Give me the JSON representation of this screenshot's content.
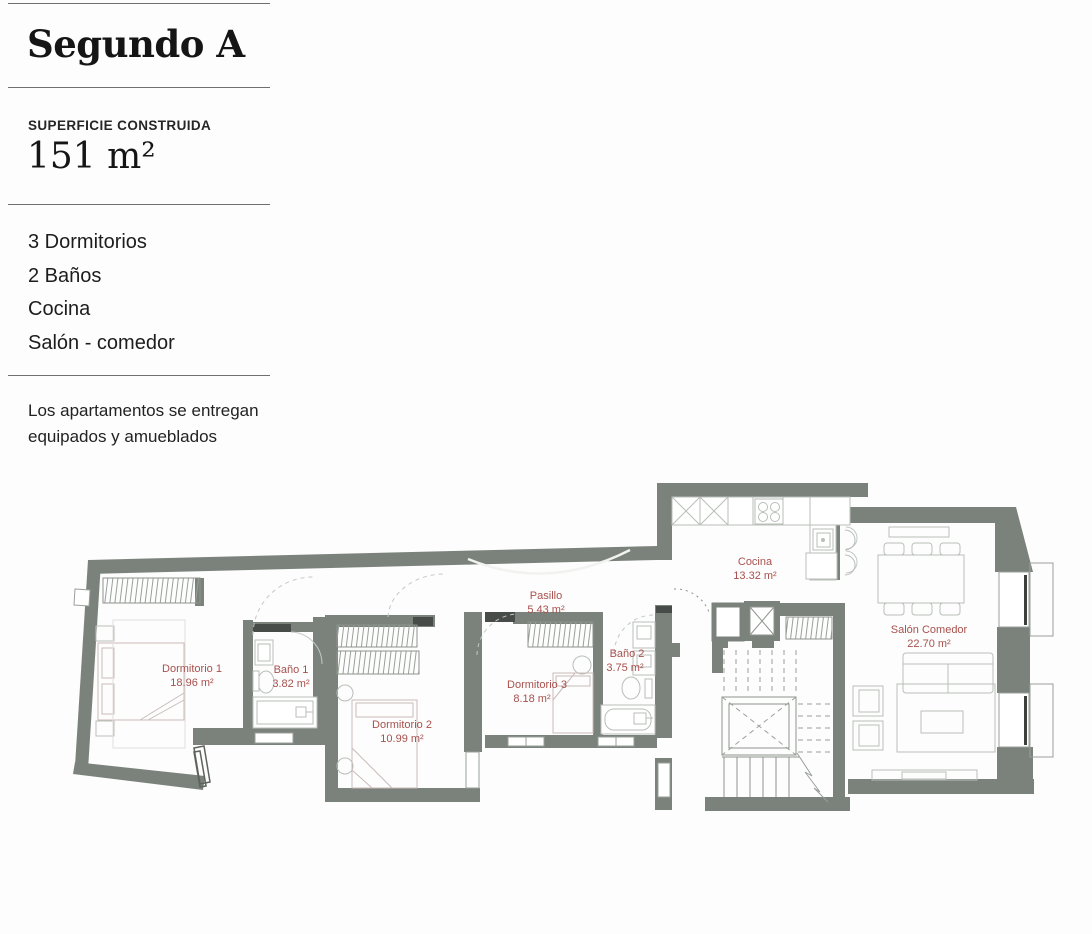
{
  "sidebar": {
    "title": "Segundo A",
    "surface": {
      "label": "SUPERFICIE CONSTRUIDA",
      "value": "151 m²"
    },
    "features": [
      "3 Dormitorios",
      "2 Baños",
      "Cocina",
      "Salón - comedor"
    ],
    "note": "Los apartamentos se entregan equipados y amueblados"
  },
  "plan": {
    "rooms": [
      {
        "name": "Dormitorio 1",
        "area": "18.96 m²"
      },
      {
        "name": "Baño 1",
        "area": "3.82 m²"
      },
      {
        "name": "Dormitorio 2",
        "area": "10.99 m²"
      },
      {
        "name": "Pasillo",
        "area": "5.43 m²"
      },
      {
        "name": "Dormitorio 3",
        "area": "8.18 m²"
      },
      {
        "name": "Baño 2",
        "area": "3.75 m²"
      },
      {
        "name": "Cocina",
        "area": "13.32 m²"
      },
      {
        "name": "Salón Comedor",
        "area": "22.70 m²"
      }
    ],
    "colors": {
      "wall": "#7b827b",
      "lintel": "#474c49",
      "label": "#a8514d",
      "furniture": "#b9beb9"
    }
  }
}
